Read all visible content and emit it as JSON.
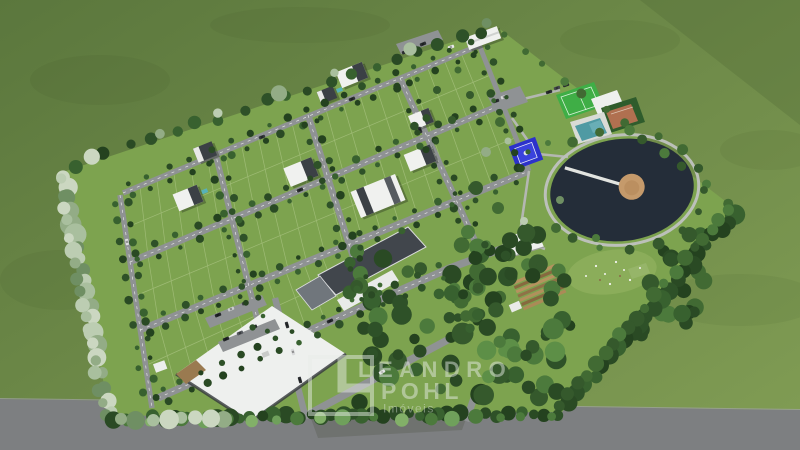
{
  "watermark": {
    "line1": "LEANDRO",
    "line2": "POHL",
    "line3": "Imóveis"
  },
  "palette": {
    "field_dark": "#5b773d",
    "field_light": "#7f9b53",
    "lawn": "#7da34f",
    "road": "#8f9294",
    "outer_road": "#7d7f81",
    "lake": "#242d39",
    "lake_path": "#bcc0ba",
    "island": "#c59a6b",
    "pier": "#e2e4e0",
    "pool": "#4f9aa3",
    "soccer_field": "#3fae46",
    "tennis_court": "#b07050",
    "playground": "#2c31cb",
    "roof_white": "#eef0ee",
    "building_dark": "#41464c",
    "watermark_color": "#e9ede9"
  }
}
